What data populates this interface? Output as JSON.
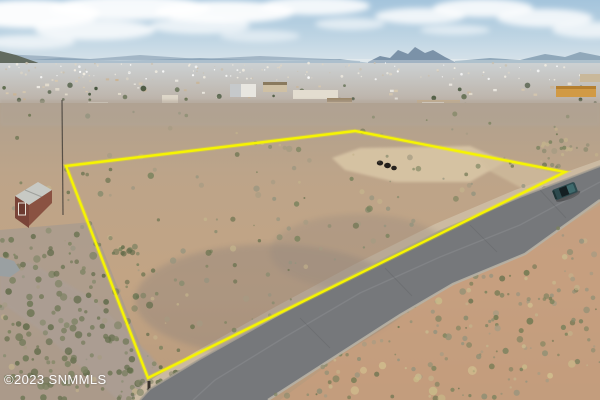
{
  "image": {
    "watermark": "©2023 SNMMLS"
  },
  "colors": {
    "boundary_yellow": "#f6f402",
    "road_gray": "#76787b",
    "truck_teal": "#2d4a4e",
    "sky_top": "#a4c4dc",
    "desert_tan": "#c0a284",
    "watermark_text": "#ffffff"
  }
}
